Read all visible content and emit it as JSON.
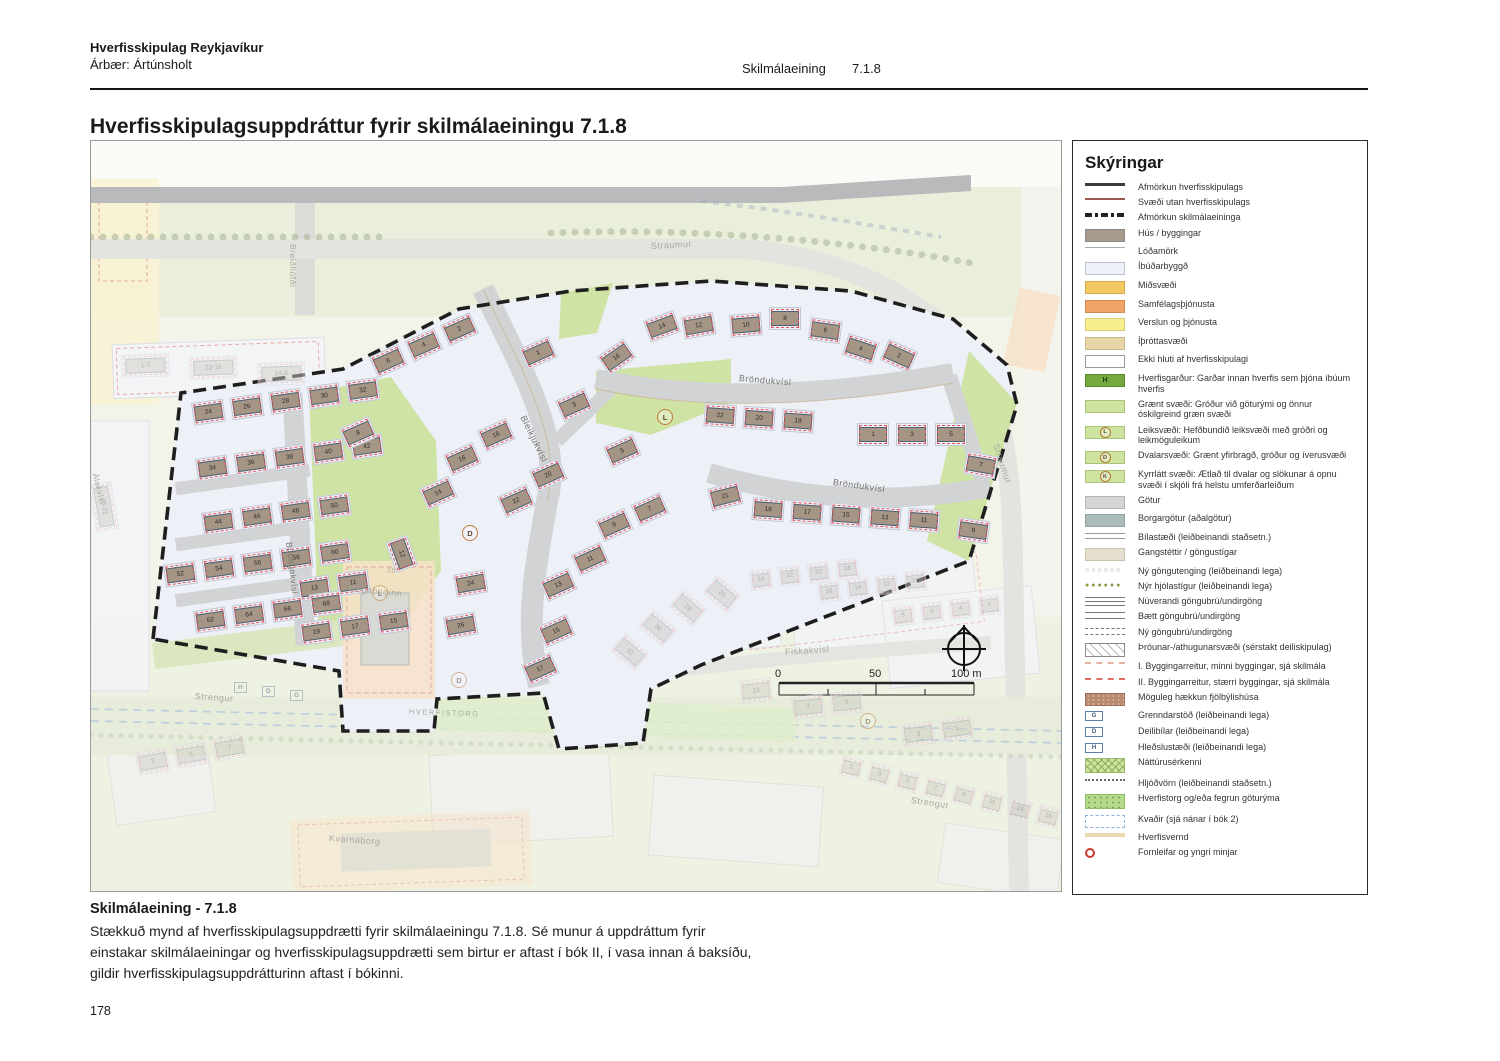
{
  "header": {
    "brand": "Hverfisskipulag Reykjavíkur",
    "sub": "Árbær: Ártúnsholt",
    "section_label": "Skilmálaeining",
    "section_number": "7.1.8",
    "title": "Hverfisskipulagsuppdráttur fyrir skilmálaeiningu 7.1.8"
  },
  "caption": {
    "title": "Skilmálaeining - 7.1.8",
    "body": "Stækkuð mynd af hverfisskipulagsuppdrætti fyrir skilmálaeiningu 7.1.8. Sé munur á uppdráttum fyrir einstakar skilmálaeiningar og hverfisskipulagsuppdrætti sem birtur er aftast í bók II, í vasa innan á baksíðu, gildir hverfisskipulagsuppdrátturinn aftast í bókinni."
  },
  "page_number": "178",
  "colors": {
    "house": "#a49585",
    "lot": "#eef0f9",
    "building_plot_dash": "#e4555a",
    "plan_boundary": "#1e1e1e",
    "green": "#cde3a4",
    "road": "#d2d3d5",
    "peach": "#f7e2c9",
    "legend_green": "#76a83f"
  },
  "map": {
    "scale_bar": {
      "start": "0",
      "mid": "50",
      "end": "100 m"
    },
    "street_labels": [
      {
        "text": "Straumur",
        "x": 560,
        "y": 100,
        "rot": -3,
        "size": 9,
        "faded": true
      },
      {
        "text": "Straumur",
        "x": 905,
        "y": 298,
        "rot": 72,
        "size": 9,
        "faded": true
      },
      {
        "text": "Breiðhöfði",
        "x": 202,
        "y": 98,
        "rot": 90,
        "size": 8.5,
        "faded": true
      },
      {
        "text": "Álakvísl",
        "x": 4,
        "y": 328,
        "rot": 76,
        "size": 8,
        "faded": true
      },
      {
        "text": "Birtingakvísl",
        "x": 198,
        "y": 396,
        "rot": 83,
        "size": 8.5,
        "faded": false
      },
      {
        "text": "Bleikjukvísl",
        "x": 432,
        "y": 270,
        "rot": 64,
        "size": 9,
        "faded": false
      },
      {
        "text": "Bröndukvísl",
        "x": 648,
        "y": 232,
        "rot": 5,
        "size": 9,
        "faded": false
      },
      {
        "text": "Bröndukvísl",
        "x": 742,
        "y": 336,
        "rot": 8,
        "size": 9,
        "faded": false
      },
      {
        "text": "Fiskakvísl",
        "x": 694,
        "y": 506,
        "rot": -4,
        "size": 9,
        "faded": true
      },
      {
        "text": "Strengur",
        "x": 104,
        "y": 550,
        "rot": 4,
        "size": 9,
        "faded": true
      },
      {
        "text": "Strengur",
        "x": 820,
        "y": 654,
        "rot": 8,
        "size": 9,
        "faded": true
      },
      {
        "text": "HVERFISTORG",
        "x": 318,
        "y": 566,
        "rot": 2,
        "size": 7.5,
        "faded": true,
        "ls": 1.5
      },
      {
        "text": "Regnboginn",
        "x": 258,
        "y": 442,
        "rot": 6,
        "size": 9,
        "faded": true
      },
      {
        "text": "10",
        "x": 296,
        "y": 426,
        "rot": 6,
        "size": 7,
        "faded": true
      },
      {
        "text": "Kvarnaborg",
        "x": 238,
        "y": 692,
        "rot": 4,
        "size": 9,
        "faded": true
      }
    ],
    "markers": [
      {
        "letter": "L",
        "x": 566,
        "y": 268,
        "style": "circle",
        "faded": false
      },
      {
        "letter": "D",
        "x": 371,
        "y": 384,
        "style": "circle",
        "faded": false
      },
      {
        "letter": "L",
        "x": 281,
        "y": 444,
        "style": "circle",
        "faded": true
      },
      {
        "letter": "D",
        "x": 360,
        "y": 531,
        "style": "circle",
        "faded": true
      },
      {
        "letter": "D",
        "x": 769,
        "y": 572,
        "style": "circle",
        "faded": true
      },
      {
        "letter": "H",
        "x": 143,
        "y": 541,
        "style": "box",
        "faded": true
      },
      {
        "letter": "D",
        "x": 171,
        "y": 545,
        "style": "box",
        "faded": true
      },
      {
        "letter": "G",
        "x": 199,
        "y": 549,
        "style": "box",
        "faded": true
      }
    ],
    "house_groups": [
      {
        "numbers": [
          "24",
          "26",
          "28",
          "30",
          "32"
        ],
        "x": 100,
        "y": 262,
        "rot": -8
      },
      {
        "numbers": [
          "34",
          "36",
          "38",
          "40",
          "42"
        ],
        "x": 104,
        "y": 318,
        "rot": -8
      },
      {
        "numbers": [
          "44",
          "46",
          "48",
          "50"
        ],
        "x": 110,
        "y": 372,
        "rot": -8
      },
      {
        "numbers": [
          "52",
          "54",
          "56",
          "58",
          "60"
        ],
        "x": 72,
        "y": 424,
        "rot": -8
      },
      {
        "numbers": [
          "13",
          "11"
        ],
        "x": 206,
        "y": 438,
        "rot": -8
      },
      {
        "numbers": [
          "62",
          "64",
          "66",
          "68"
        ],
        "x": 102,
        "y": 470,
        "rot": -8
      },
      {
        "numbers": [
          "19",
          "17",
          "15"
        ],
        "x": 208,
        "y": 482,
        "rot": -8
      },
      {
        "numbers": [
          "6",
          "4",
          "2"
        ],
        "x": 278,
        "y": 216,
        "rot": -24
      },
      {
        "numbers": [
          "8"
        ],
        "x": 248,
        "y": 288,
        "rot": -24
      },
      {
        "numbers": [
          "1"
        ],
        "x": 428,
        "y": 208,
        "rot": -24
      },
      {
        "numbers": [
          "3"
        ],
        "x": 464,
        "y": 260,
        "rot": -24
      },
      {
        "numbers": [
          "18"
        ],
        "x": 386,
        "y": 290,
        "rot": -24
      },
      {
        "numbers": [
          "16"
        ],
        "x": 352,
        "y": 314,
        "rot": -24
      },
      {
        "numbers": [
          "14"
        ],
        "x": 328,
        "y": 348,
        "rot": -24
      },
      {
        "numbers": [
          "20"
        ],
        "x": 438,
        "y": 330,
        "rot": -24
      },
      {
        "numbers": [
          "22"
        ],
        "x": 406,
        "y": 356,
        "rot": -24
      },
      {
        "numbers": [
          "12"
        ],
        "x": 316,
        "y": 394,
        "rot": 70
      },
      {
        "numbers": [
          "24"
        ],
        "x": 362,
        "y": 434,
        "rot": -10
      },
      {
        "numbers": [
          "26"
        ],
        "x": 352,
        "y": 476,
        "rot": -10
      },
      {
        "numbers": [
          "16"
        ],
        "x": 506,
        "y": 216,
        "rot": -35
      },
      {
        "numbers": [
          "14"
        ],
        "x": 552,
        "y": 180,
        "rot": -20
      },
      {
        "numbers": [
          "12"
        ],
        "x": 590,
        "y": 176,
        "rot": -10
      },
      {
        "numbers": [
          "10"
        ],
        "x": 638,
        "y": 174,
        "rot": -5
      },
      {
        "numbers": [
          "8"
        ],
        "x": 678,
        "y": 166,
        "rot": 0
      },
      {
        "numbers": [
          "6"
        ],
        "x": 720,
        "y": 176,
        "rot": 8
      },
      {
        "numbers": [
          "4"
        ],
        "x": 758,
        "y": 192,
        "rot": 18
      },
      {
        "numbers": [
          "2"
        ],
        "x": 798,
        "y": 198,
        "rot": 24
      },
      {
        "numbers": [
          "22",
          "20",
          "18"
        ],
        "x": 614,
        "y": 262,
        "rot": 4
      },
      {
        "numbers": [
          "1",
          "3",
          "5"
        ],
        "x": 766,
        "y": 282,
        "rot": 0
      },
      {
        "numbers": [
          "7"
        ],
        "x": 876,
        "y": 310,
        "rot": 10
      },
      {
        "numbers": [
          "21"
        ],
        "x": 616,
        "y": 348,
        "rot": -14
      },
      {
        "numbers": [
          "19",
          "17",
          "15",
          "13",
          "11"
        ],
        "x": 662,
        "y": 356,
        "rot": 4
      },
      {
        "numbers": [
          "9"
        ],
        "x": 868,
        "y": 376,
        "rot": 8
      },
      {
        "numbers": [
          "5"
        ],
        "x": 512,
        "y": 306,
        "rot": -24
      },
      {
        "numbers": [
          "9",
          "7"
        ],
        "x": 504,
        "y": 380,
        "rot": -24
      },
      {
        "numbers": [
          "11"
        ],
        "x": 480,
        "y": 414,
        "rot": -24
      },
      {
        "numbers": [
          "13"
        ],
        "x": 448,
        "y": 440,
        "rot": -24
      },
      {
        "numbers": [
          "15"
        ],
        "x": 446,
        "y": 486,
        "rot": -24
      },
      {
        "numbers": [
          "17"
        ],
        "x": 430,
        "y": 524,
        "rot": -24
      },
      {
        "numbers": [
          "1-7"
        ],
        "x": 30,
        "y": 214,
        "rot": -2,
        "faded": true,
        "wide": true
      },
      {
        "numbers": [
          "22-16"
        ],
        "x": 98,
        "y": 216,
        "rot": -2,
        "faded": true,
        "wide": true
      },
      {
        "numbers": [
          "14-8"
        ],
        "x": 166,
        "y": 222,
        "rot": -2,
        "faded": true,
        "wide": true
      },
      {
        "numbers": [
          "25-21"
        ],
        "x": 20,
        "y": 340,
        "rot": 80,
        "faded": true,
        "wide": true
      },
      {
        "numbers": [
          "26"
        ],
        "x": 626,
        "y": 434,
        "rot": 40,
        "faded": true
      },
      {
        "numbers": [
          "28"
        ],
        "x": 592,
        "y": 448,
        "rot": 40,
        "faded": true
      },
      {
        "numbers": [
          "30"
        ],
        "x": 562,
        "y": 468,
        "rot": 40,
        "faded": true
      },
      {
        "numbers": [
          "32"
        ],
        "x": 534,
        "y": 492,
        "rot": 40,
        "faded": true
      },
      {
        "numbers": [
          "24",
          "22",
          "20",
          "18"
        ],
        "x": 658,
        "y": 430,
        "rot": -7,
        "faded": true,
        "sm": true
      },
      {
        "numbers": [
          "16",
          "14",
          "12",
          "10"
        ],
        "x": 726,
        "y": 442,
        "rot": -7,
        "faded": true,
        "sm": true
      },
      {
        "numbers": [
          "8",
          "6",
          "4",
          "2"
        ],
        "x": 800,
        "y": 466,
        "rot": -7,
        "faded": true,
        "sm": true
      },
      {
        "numbers": [
          "3",
          "5",
          "7"
        ],
        "x": 44,
        "y": 612,
        "rot": -10,
        "faded": true
      },
      {
        "numbers": [
          "1",
          "3",
          "5",
          "7",
          "9",
          "11",
          "13",
          "15"
        ],
        "x": 752,
        "y": 614,
        "rot": 14,
        "faded": true,
        "sm": true
      },
      {
        "numbers": [
          "13"
        ],
        "x": 648,
        "y": 540,
        "rot": -6,
        "faded": true
      },
      {
        "numbers": [
          "7",
          "5"
        ],
        "x": 700,
        "y": 556,
        "rot": -6,
        "faded": true
      },
      {
        "numbers": [
          "3",
          "1"
        ],
        "x": 810,
        "y": 584,
        "rot": -8,
        "faded": true
      }
    ]
  },
  "legend": {
    "title": "Skýringar",
    "items": [
      {
        "sw": "line-afm",
        "label": "Afmörkun hverfisskipulags"
      },
      {
        "sw": "line-utan",
        "label": "Svæði utan hverfisskipulags"
      },
      {
        "sw": "line-skil",
        "label": "Afmörkun skilmálaeininga"
      },
      {
        "sw": "hus",
        "label": "Hús / byggingar"
      },
      {
        "sw": "line-lod",
        "label": "Lóðamörk"
      },
      {
        "sw": "ibud",
        "label": "Íbúðarbyggð"
      },
      {
        "sw": "mid",
        "label": "Miðsvæði"
      },
      {
        "sw": "samf",
        "label": "Samfélagsþjónusta"
      },
      {
        "sw": "versl",
        "label": "Verslun og þjónusta"
      },
      {
        "sw": "ithrott",
        "label": "Íþróttasvæði"
      },
      {
        "sw": "ekki",
        "label": "Ekki hluti af hverfisskipulagi"
      },
      {
        "sw": "hgard",
        "letter": "H",
        "label": "Hverfisgarður: Garðar innan hverfis sem þjóna íbúum hverfis"
      },
      {
        "sw": "graent",
        "label": "Grænt svæði: Gróður við göturými og önnur óskilgreind græn svæði"
      },
      {
        "sw": "graent",
        "letter": "L",
        "label": "Leiksvæði: Hefðbundið leiksvæði með gróðri og leikmöguleikum"
      },
      {
        "sw": "graent",
        "letter": "D",
        "label": "Dvalarsvæði: Grænt yfirbragð, gróður og íverusvæði"
      },
      {
        "sw": "graent",
        "letter": "K",
        "label": "Kyrrlátt svæði: Ætlað til dvalar og slökunar á opnu svæði í skjóli frá helstu umferðarleiðum"
      },
      {
        "sw": "gotur",
        "label": "Götur"
      },
      {
        "sw": "borgar",
        "label": "Borgargötur (aðalgötur)"
      },
      {
        "sw": "bil",
        "label": "Bílastæði (leiðbeinandi staðsetn.)"
      },
      {
        "sw": "gang",
        "label": "Gangstéttir / göngustígar"
      },
      {
        "sw": "dots-open",
        "label": "Ný göngutenging (leiðbeinandi lega)"
      },
      {
        "sw": "dots-fill",
        "label": "Nýr hjólastígur (leiðbeinandi lega)"
      },
      {
        "sw": "lines3",
        "label": "Núverandi göngubrú/undirgöng"
      },
      {
        "sw": "lines2",
        "label": "Bætt göngubrú/undirgöng"
      },
      {
        "sw": "linesdash",
        "label": "Ný göngubrú/undirgöng"
      },
      {
        "sw": "hatch",
        "label": "Þróunar-/athugunarsvæði (sérstakt deiliskipulag)"
      },
      {
        "sw": "dashI",
        "label": "I. Byggingarreitur, minni byggingar, sjá skilmála"
      },
      {
        "sw": "dashII",
        "label": "II. Byggingarreitur, stærri byggingar, sjá skilmála"
      },
      {
        "sw": "haekkun",
        "label": "Möguleg hækkun fjölbýlishúsa"
      },
      {
        "sw": "iconbox",
        "letter": "G",
        "label": "Grenndarstöð (leiðbeinandi lega)"
      },
      {
        "sw": "iconbox",
        "letter": "D",
        "label": "Deilibílar (leiðbeinandi lega)"
      },
      {
        "sw": "iconbox",
        "letter": "H",
        "label": "Hleðslustæði (leiðbeinandi lega)"
      },
      {
        "sw": "natt",
        "label": "Náttúrusérkenni"
      },
      {
        "sw": "hljod",
        "label": "Hljóðvörn (leiðbeinandi staðsetn.)"
      },
      {
        "sw": "torg",
        "label": "Hverfistorg og/eða fegrun göturýma"
      },
      {
        "sw": "kvadir",
        "label": "Kvaðir (sjá nánar í bók 2)"
      },
      {
        "sw": "vernd",
        "label": "Hverfisvernd"
      },
      {
        "sw": "forn",
        "label": "Fornleifar og yngri minjar"
      }
    ]
  }
}
